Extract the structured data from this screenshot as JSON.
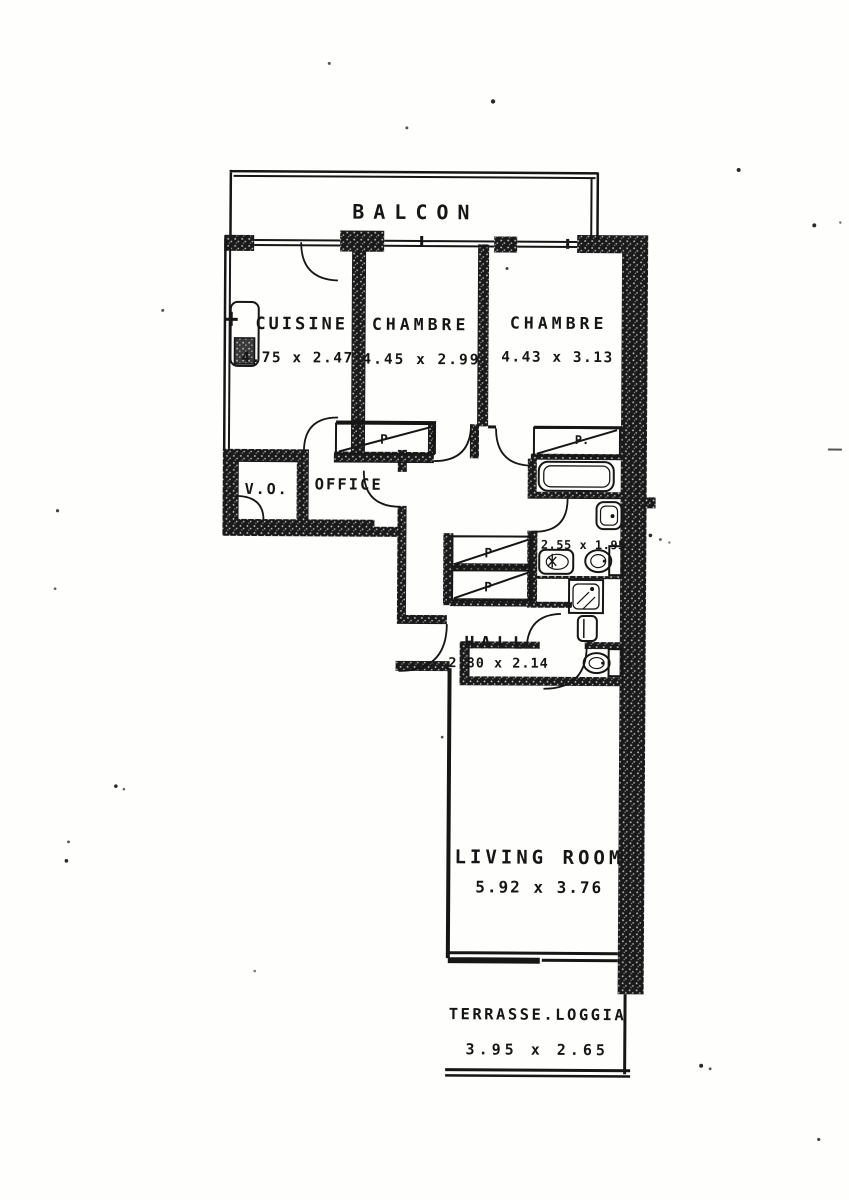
{
  "plan": {
    "balcony": {
      "label": "BALCON"
    },
    "cuisine": {
      "label": "CUISINE",
      "dims": "4.75 x 2.47"
    },
    "chambre_left": {
      "label": "CHAMBRE",
      "dims": "4.45 x 2.99"
    },
    "chambre_right": {
      "label": "CHAMBRE",
      "dims": "4.43 x 3.13"
    },
    "vo": {
      "label": "V.O."
    },
    "office": {
      "label": "OFFICE"
    },
    "bathroom": {
      "dims": "2.55 x 1.95"
    },
    "hall": {
      "label": "HALL",
      "dims": "2.80 x 2.14"
    },
    "living_room": {
      "label": "LIVING ROOM",
      "dims": "5.92 x 3.76"
    },
    "terrasse": {
      "label": "TERRASSE.LOGGIA",
      "dims": "3.95 x 2.65"
    },
    "closets": {
      "corridor_left": "P",
      "corridor_right": "P.",
      "hall_top": "P",
      "hall_bottom": "P"
    }
  },
  "colors": {
    "ink": "#161616",
    "paper": "#fefefd"
  }
}
